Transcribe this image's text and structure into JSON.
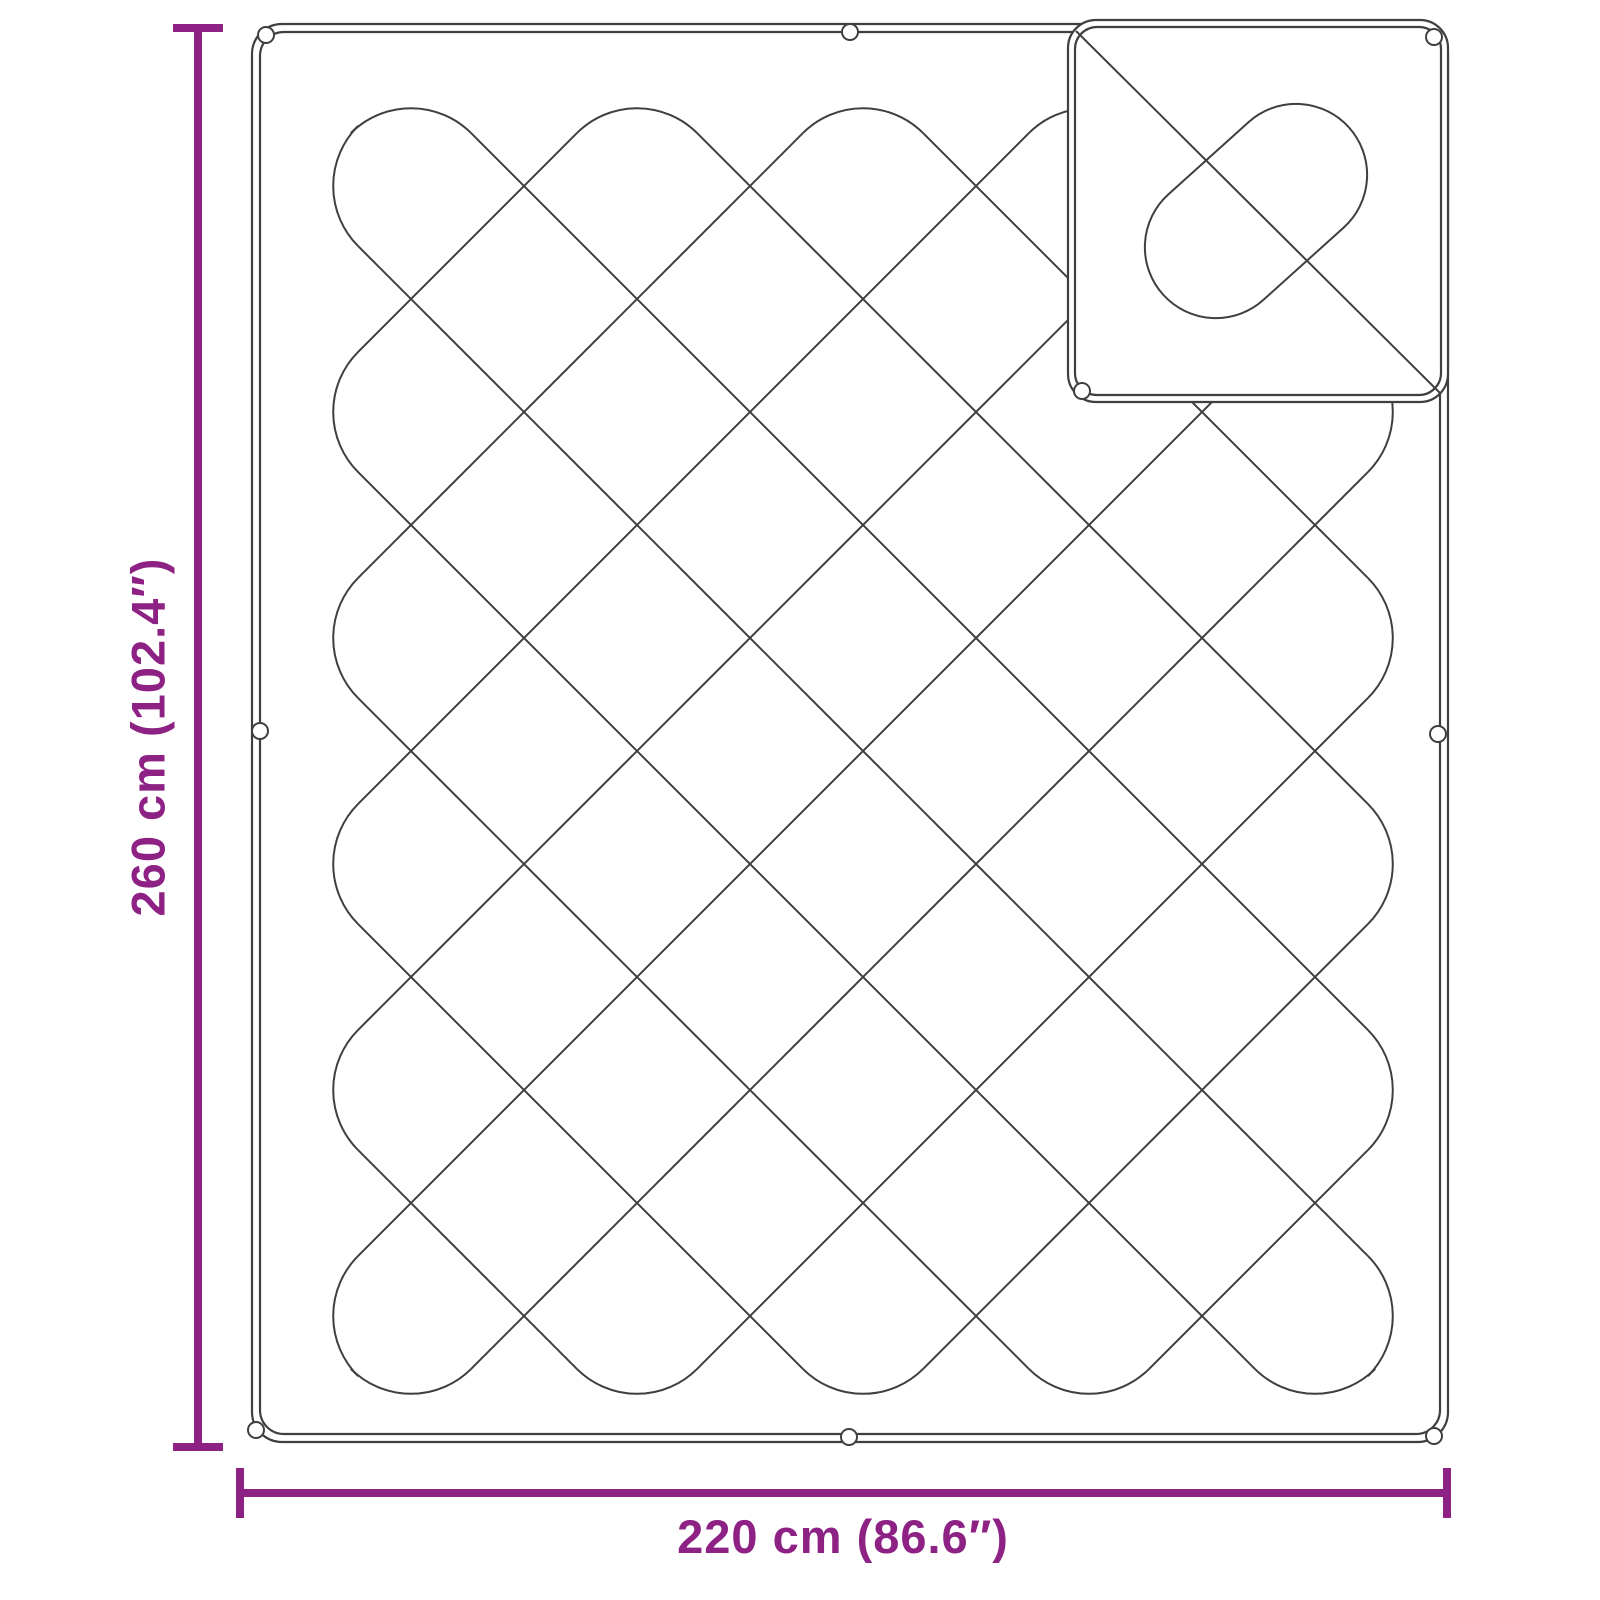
{
  "figure": {
    "type": "product-dimension-diagram",
    "subject": "quilted blanket with folded corner flap"
  },
  "dimensions": {
    "height": {
      "label": "260 cm (102.4″)",
      "value_cm": 260,
      "value_inch": 102.4
    },
    "width": {
      "label": "220 cm (86.6″)",
      "value_cm": 220,
      "value_inch": 86.6
    }
  },
  "colors": {
    "dimension_accent": "#8d2184",
    "outline": "#3f3f3f",
    "background": "#ffffff"
  }
}
